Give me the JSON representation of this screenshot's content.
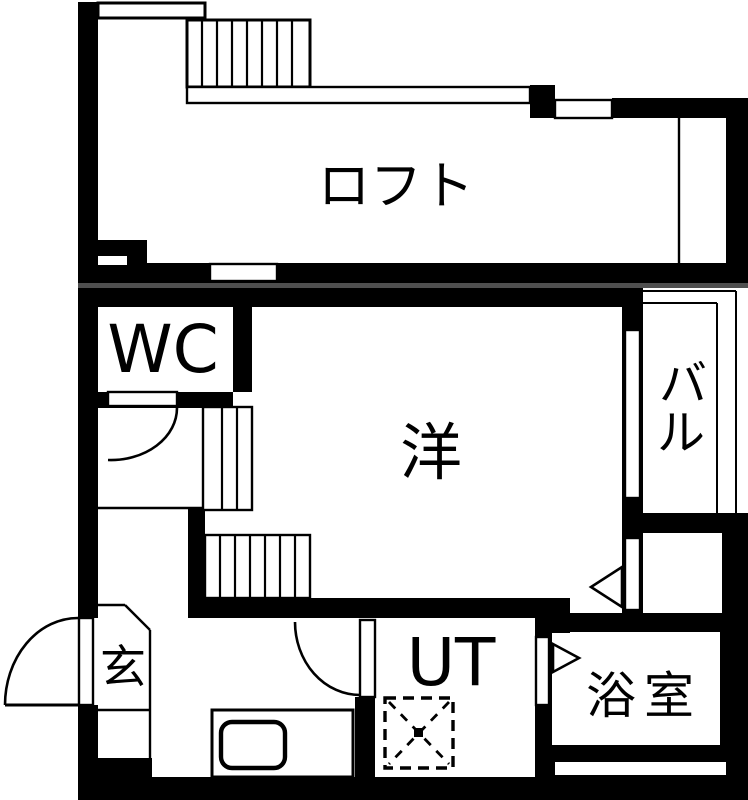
{
  "plan": {
    "rooms": {
      "loft": {
        "label": "ロフト"
      },
      "wc": {
        "label": "WC"
      },
      "western_room": {
        "label": "洋"
      },
      "balcony": {
        "char1": "バ",
        "char2": "ル"
      },
      "entrance": {
        "label": "玄"
      },
      "utility": {
        "label": "UT"
      },
      "bathroom": {
        "label": "浴室"
      }
    },
    "colors": {
      "wall": "#000000",
      "floor": "#ffffff",
      "divider": "#4f4f4f"
    }
  }
}
